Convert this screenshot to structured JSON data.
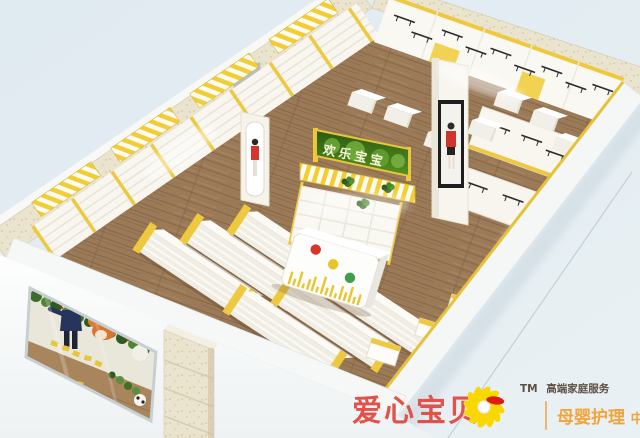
{
  "scene": {
    "store_sign_text": "欢乐宝宝"
  },
  "branding": {
    "name": "爱心宝贝",
    "trademark": "TM",
    "tagline": "高端家庭服务",
    "service_main": "母婴护理",
    "service_suffix": "中心"
  },
  "colors": {
    "brand-red": "#e2514a",
    "brand-orange": "#f0a43c",
    "logo-yellow": "#f8d800",
    "logo-accent-red": "#dd1d0e",
    "tagline-gray": "#5d4f44",
    "accent-yellow": "#eec93f",
    "sign-green": "#46761f",
    "floor-brown": "#9b7a58",
    "background-blue": "#e3ecf2"
  }
}
